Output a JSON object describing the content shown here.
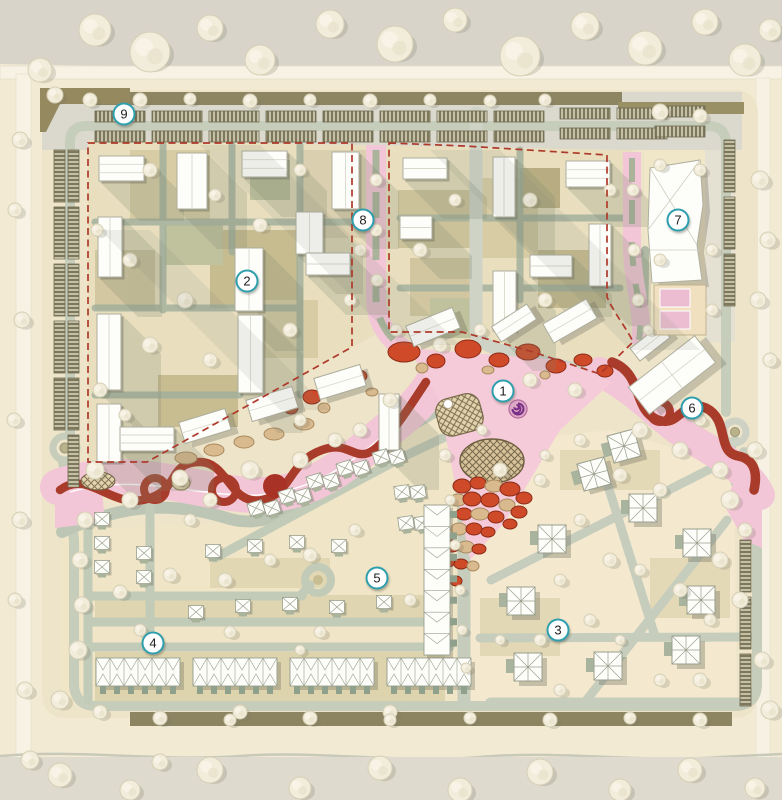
{
  "title": "Urban masterplan site plan",
  "map": {
    "type": "masterplan-illustrative-site-plan",
    "markers": [
      {
        "label": "1",
        "x": 503,
        "y": 391
      },
      {
        "label": "2",
        "x": 247,
        "y": 281
      },
      {
        "label": "3",
        "x": 558,
        "y": 630
      },
      {
        "label": "4",
        "x": 153,
        "y": 643
      },
      {
        "label": "5",
        "x": 377,
        "y": 578
      },
      {
        "label": "6",
        "x": 692,
        "y": 408
      },
      {
        "label": "7",
        "x": 678,
        "y": 220
      },
      {
        "label": "8",
        "x": 363,
        "y": 220
      },
      {
        "label": "9",
        "x": 124,
        "y": 114
      }
    ]
  },
  "palette": {
    "teal": "#2f9fae",
    "markerFill": "#ffffff",
    "ink": "#1d1d1b",
    "boundary": "#ae3a2b",
    "ribbon": "#a93b2a",
    "mosaicRed": "#cf4a28",
    "mosaicTan": "#d9b98e",
    "pink": "#f2c6d6",
    "roadSage": "#9fae9b",
    "roadLight": "#c6cdbd",
    "ground": "#f3ead3",
    "groundTan": "#e9dfbf",
    "olive": "#c8bd92",
    "oliveDark": "#a89c70",
    "building": "#fdfdfa",
    "outline": "#abab99",
    "tree": "#f2ecda",
    "treeEdge": "#d6cfb6",
    "shadow": "#7d836e",
    "bandGray": "#d8d4c9",
    "verge": "#8d8562",
    "purple": "#7a2f86",
    "hatch": "#7e785a"
  }
}
